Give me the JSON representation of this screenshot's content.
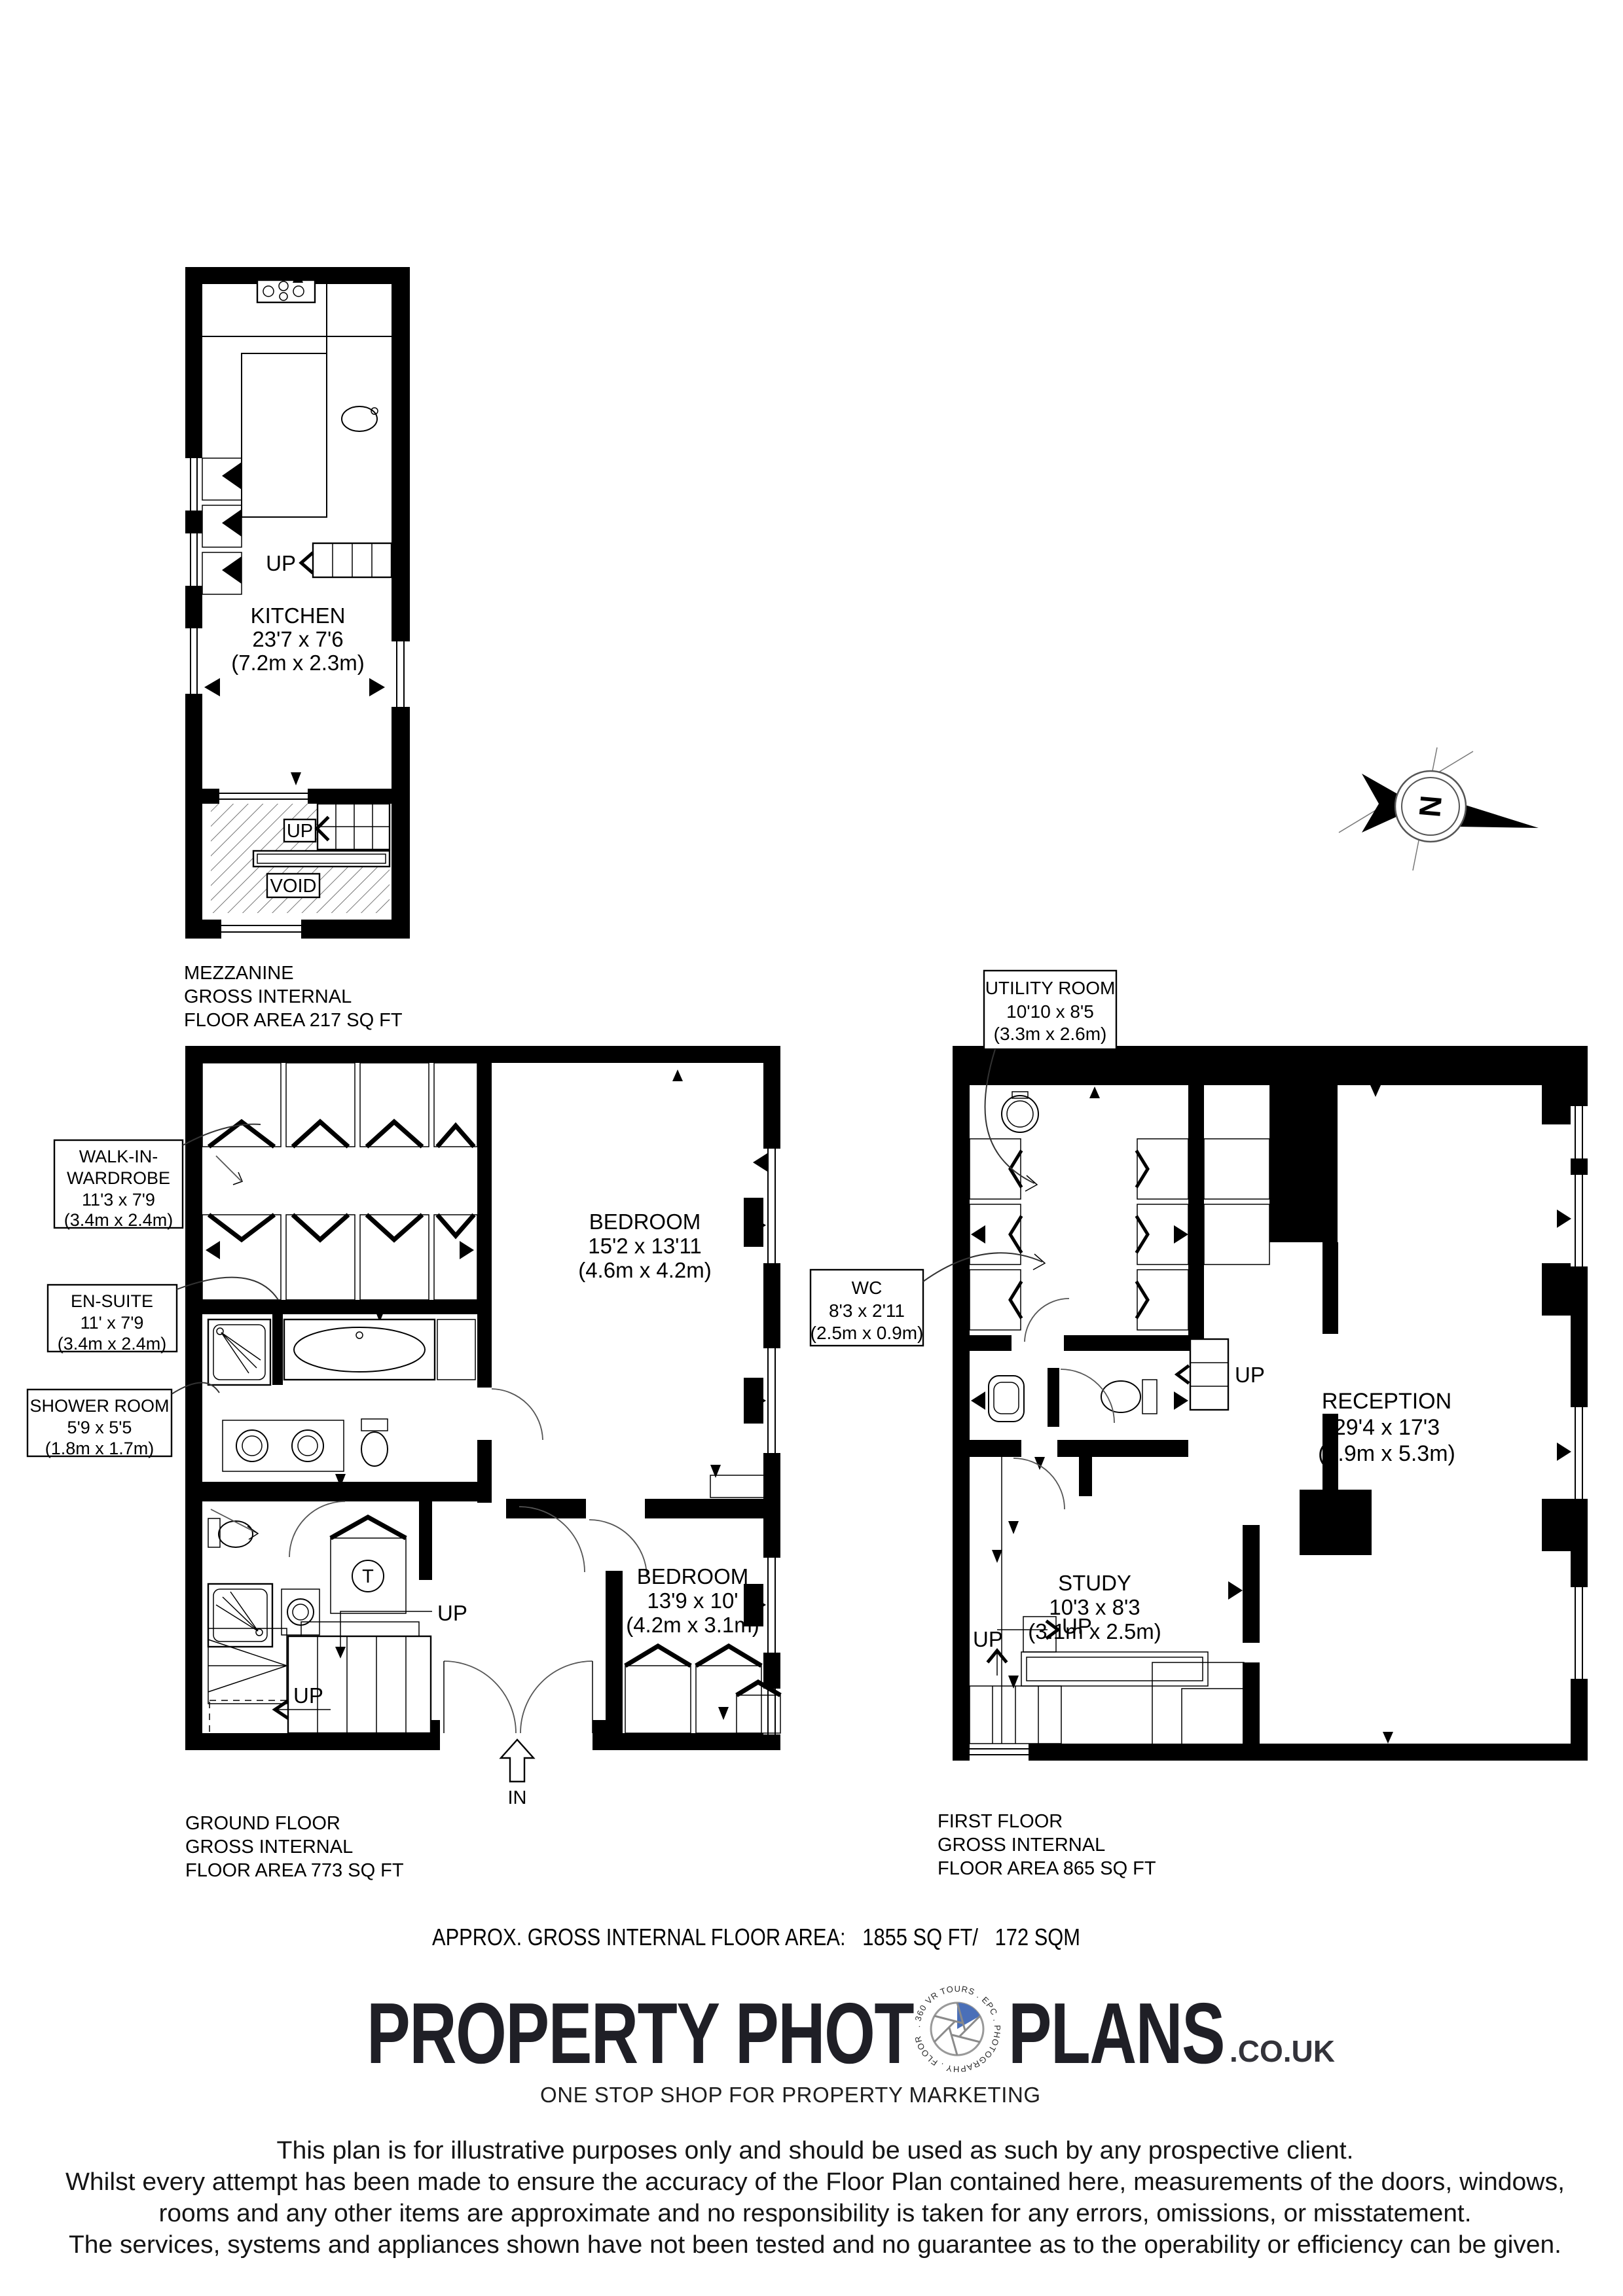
{
  "compass": {
    "label": "N"
  },
  "plans": {
    "mezzanine": {
      "rooms": {
        "kitchen": {
          "name": "KITCHEN",
          "dims": "23'7 x 7'6",
          "metric": "(7.2m x 2.3m)"
        }
      },
      "labels": {
        "up1": "UP",
        "up2": "UP",
        "void": "VOID"
      },
      "title": {
        "line1": "MEZZANINE",
        "line2": "GROSS INTERNAL",
        "line3": "FLOOR AREA 217 SQ FT"
      }
    },
    "ground": {
      "rooms": {
        "bedroom1": {
          "name": "BEDROOM",
          "dims": "15'2 x 13'11",
          "metric": "(4.6m x 4.2m)"
        },
        "bedroom2": {
          "name": "BEDROOM",
          "dims": "13'9 x 10'",
          "metric": "(4.2m x 3.1m)"
        }
      },
      "callouts": {
        "wardrobe": {
          "line1": "WALK-IN-",
          "line2": "WARDROBE",
          "dims": "11'3 x 7'9",
          "metric": "(3.4m x 2.4m)"
        },
        "ensuite": {
          "name": "EN-SUITE",
          "dims": "11' x 7'9",
          "metric": "(3.4m x 2.4m)"
        },
        "shower": {
          "name": "SHOWER ROOM",
          "dims": "5'9 x 5'5",
          "metric": "(1.8m x 1.7m)"
        }
      },
      "labels": {
        "up1": "UP",
        "up2": "UP",
        "in": "IN",
        "tank": "T"
      },
      "title": {
        "line1": "GROUND FLOOR",
        "line2": "GROSS INTERNAL",
        "line3": "FLOOR AREA 773 SQ FT"
      }
    },
    "first": {
      "rooms": {
        "reception": {
          "name": "RECEPTION",
          "dims": "29'4 x 17'3",
          "metric": "(8.9m x 5.3m)"
        },
        "study": {
          "name": "STUDY",
          "dims": "10'3 x 8'3",
          "metric": "(3.1m x 2.5m)"
        }
      },
      "callouts": {
        "utility": {
          "name": "UTILITY ROOM",
          "dims": "10'10 x 8'5",
          "metric": "(3.3m x 2.6m)"
        },
        "wc": {
          "name": "WC",
          "dims": "8'3 x 2'11",
          "metric": "(2.5m x 0.9m)"
        }
      },
      "labels": {
        "up1": "UP",
        "up2": "UP",
        "up3": "UP"
      },
      "title": {
        "line1": "FIRST FLOOR",
        "line2": "GROSS INTERNAL",
        "line3": "FLOOR AREA 865 SQ FT"
      }
    }
  },
  "summary": {
    "total_area": "APPROX. GROSS INTERNAL FLOOR AREA:   1855 SQ FT/   172 SQM"
  },
  "logo": {
    "part1": "PROPERTY PHOT",
    "part2": "PLANS",
    "suffix": ".CO.UK",
    "tagline": "ONE STOP SHOP FOR PROPERTY MARKETING",
    "ring_text": ". 360 VR TOURS . EPC . PHOTOGRAPHY . FLOOR PLANS",
    "accent_color": "#4a6fb8"
  },
  "disclaimer": {
    "line1": "This plan is for illustrative purposes only and should be used as such by any prospective client.",
    "line2": "Whilst every attempt has been made to ensure the accuracy of the Floor Plan contained here, measurements of the doors, windows,",
    "line3": "rooms and any other items are approximate and no responsibility is taken for any errors, omissions, or misstatement.",
    "line4": "The services, systems and appliances shown have not been tested and no guarantee as to the operability or efficiency can be given."
  }
}
